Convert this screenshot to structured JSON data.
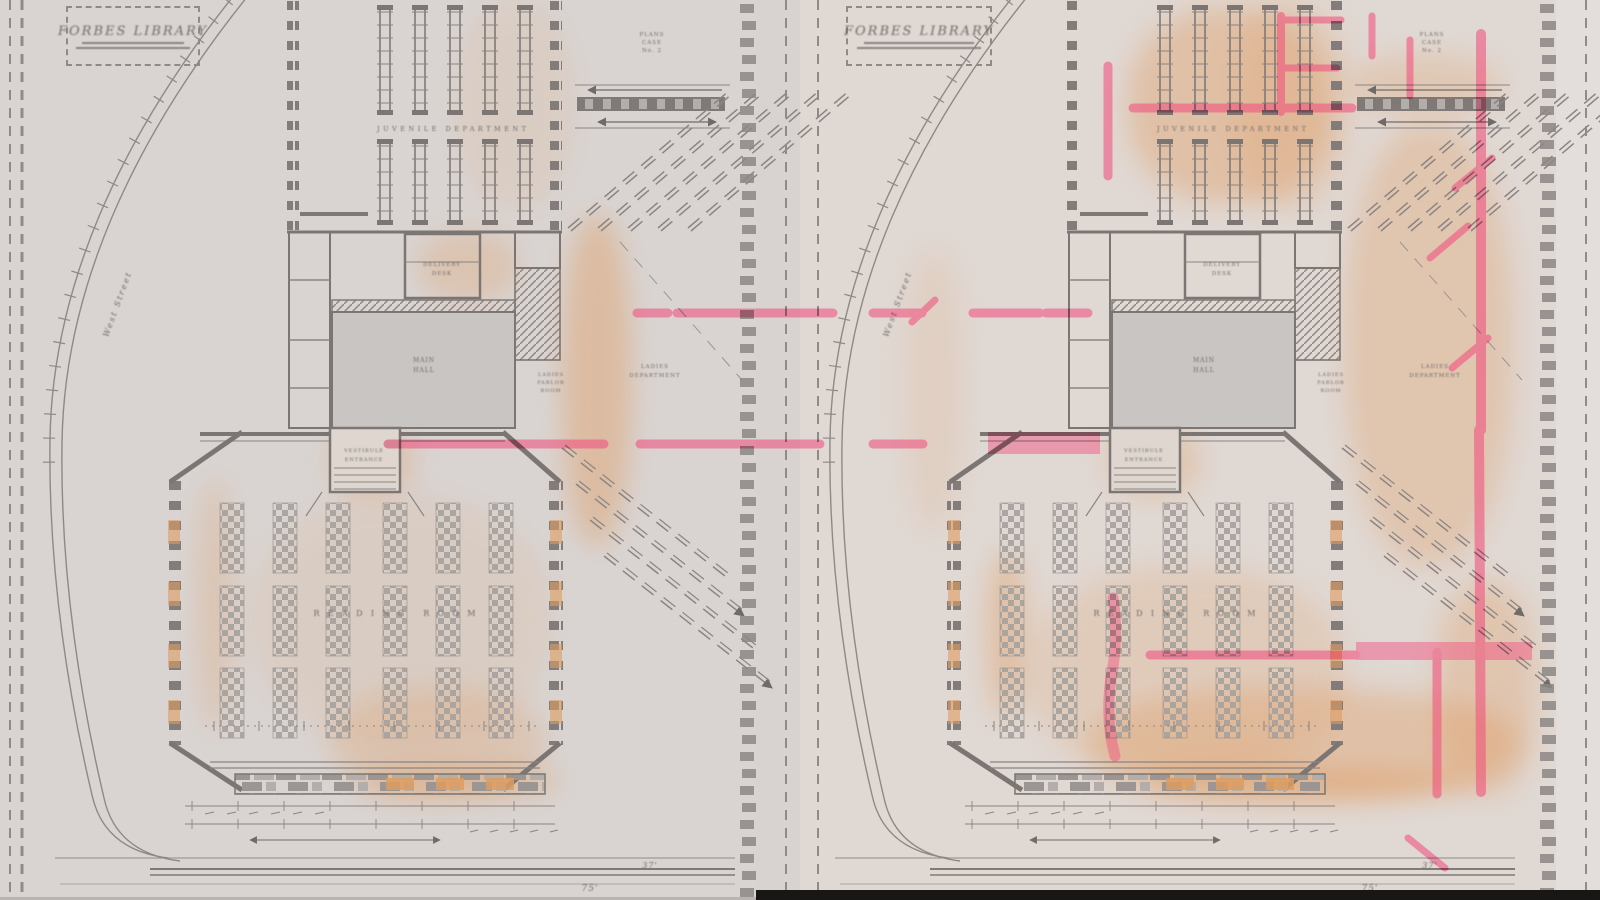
{
  "page": {
    "description": "Scanned sheet with two nearly identical library floor plans side by side; the right-hand plan carries red pencil mark-ups"
  },
  "titles": {
    "left": "FORBES LIBRARY",
    "right": "FORBES LIBRARY"
  },
  "labels": {
    "stack_room": "JUVENILE DEPARTMENT",
    "delivery_line1": "DELIVERY",
    "delivery_line2": "DESK",
    "hall_line1": "MAIN",
    "hall_line2": "HALL",
    "parlor_line1": "LADIES",
    "parlor_line2": "PARLOR",
    "parlor_line3": "ROOM",
    "entrance_line1": "VESTIBULE",
    "entrance_line2": "ENTRANCE",
    "reading_room": "READING ROOM",
    "dept_line1": "LADIES",
    "dept_line2": "DEPARTMENT",
    "road": "West Street",
    "stamp_line1": "PLANS",
    "stamp_line2": "CASE",
    "stamp_line3": "No. 2",
    "dim_75": "75'",
    "dim_37": "37'"
  }
}
